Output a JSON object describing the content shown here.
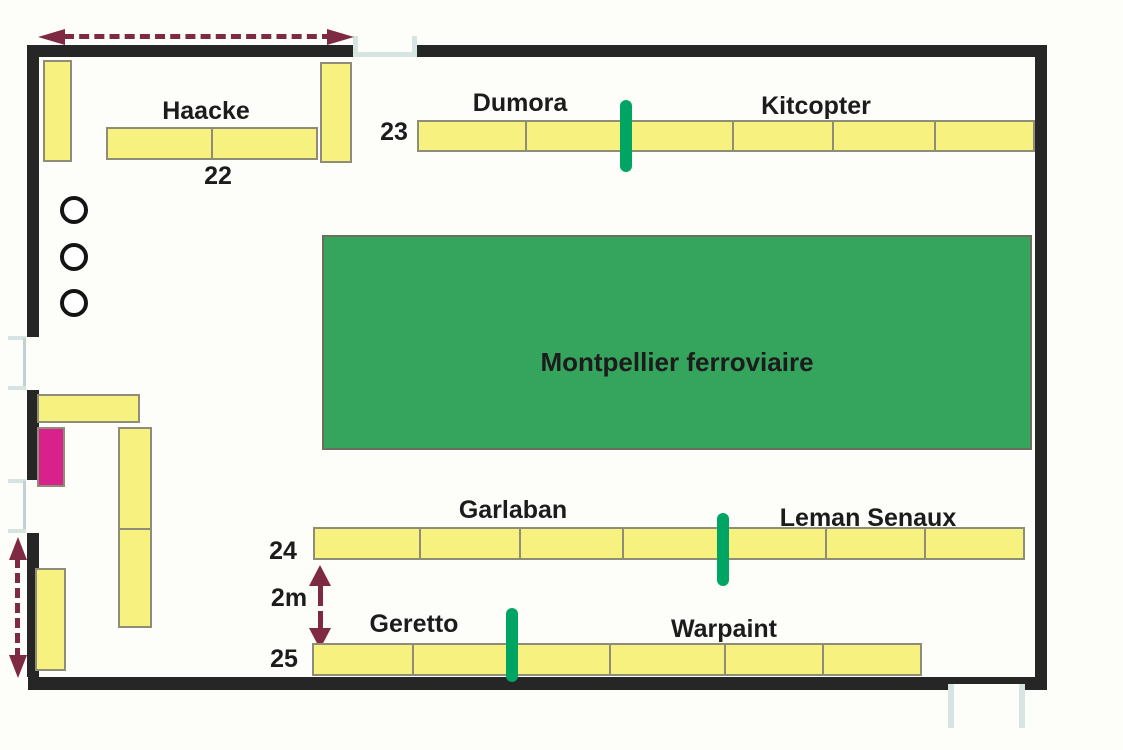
{
  "title": "Exhibition hall floor plan",
  "colors": {
    "wall": "#262626",
    "stand": "#f7f17f",
    "stand-border": "#8f8c78",
    "zone": "#35a45c",
    "divider": "#00a564",
    "arrow": "#7d2a42",
    "pink": "#d8218a",
    "door": "#d7e5e2",
    "ink": "#1c1c1c"
  },
  "zone": {
    "label": "Montpellier ferroviaire"
  },
  "stands": {
    "row22": {
      "number": "22",
      "name": "Haacke"
    },
    "row23": {
      "number": "23",
      "left_name": "Dumora",
      "right_name": "Kitcopter"
    },
    "row24": {
      "number": "24",
      "left_name": "Garlaban",
      "right_name": "Leman Senaux"
    },
    "row25": {
      "number": "25",
      "left_name": "Geretto",
      "right_name": "Warpaint"
    }
  },
  "annotations": {
    "aisle_width": "2m"
  }
}
